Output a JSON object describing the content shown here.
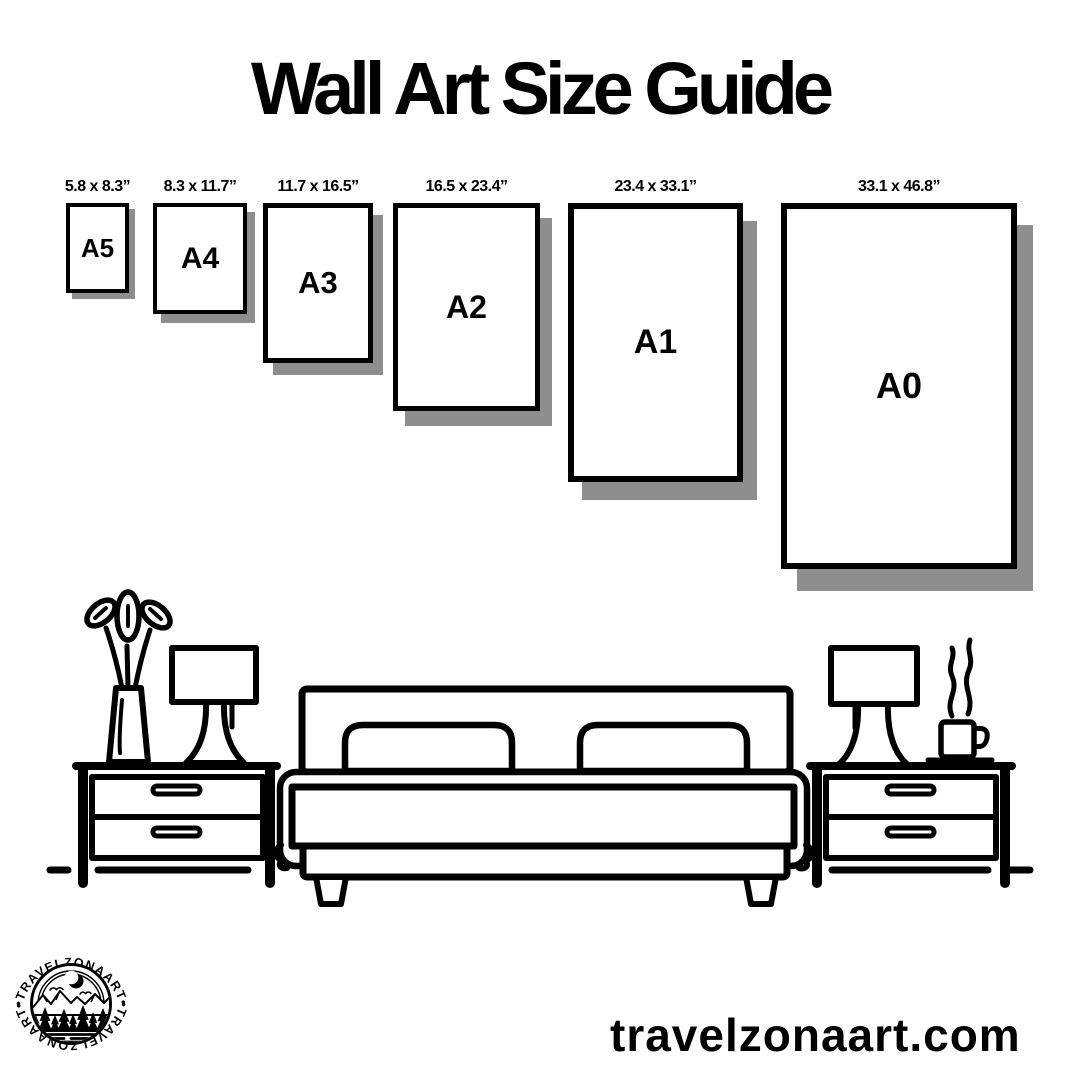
{
  "title": "Wall Art Size Guide",
  "sizes": [
    {
      "label": "A5",
      "dimensions": "5.8 x 8.3”"
    },
    {
      "label": "A4",
      "dimensions": "8.3 x 11.7”"
    },
    {
      "label": "A3",
      "dimensions": "11.7 x 16.5”"
    },
    {
      "label": "A2",
      "dimensions": "16.5 x 23.4”"
    },
    {
      "label": "A1",
      "dimensions": "23.4 x 33.1”"
    },
    {
      "label": "A0",
      "dimensions": "33.1 x 46.8”"
    }
  ],
  "logo": {
    "arc_top": "•TRAVELZONAART•",
    "arc_bottom": "•TRAVELZONAART•"
  },
  "footer": {
    "website": "travelzonaart.com"
  },
  "colors": {
    "ink": "#000000",
    "shadow": "#8e8e8e",
    "background": "#ffffff"
  },
  "illustration_icons": [
    "bed-icon",
    "pillow-icon",
    "nightstand-icon",
    "table-lamp-icon",
    "vase-plant-icon",
    "coffee-cup-icon",
    "moon-icon",
    "mountains-icon",
    "forest-icon"
  ]
}
